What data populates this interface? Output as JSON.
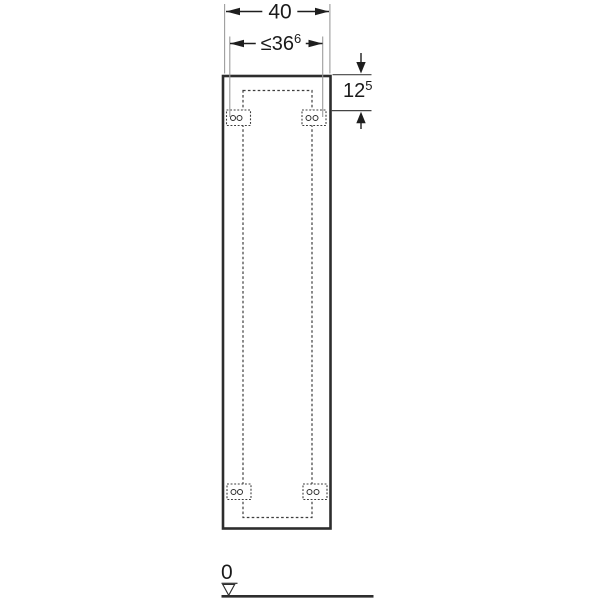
{
  "dimensions": {
    "outer_width": {
      "value": "40"
    },
    "fastening_width": {
      "main": "≤36",
      "superscript": "6"
    },
    "top_offset": {
      "main": "12",
      "superscript": "5"
    }
  },
  "datum": {
    "label": "0"
  },
  "colors": {
    "outline_dark": "#2d2d2d",
    "dimension_line": "#1e1e1e",
    "extension_line_gray": "#9c9c9c",
    "dashed_line": "#3e3e3e",
    "text": "#1a1a1a",
    "background": "#ffffff"
  }
}
